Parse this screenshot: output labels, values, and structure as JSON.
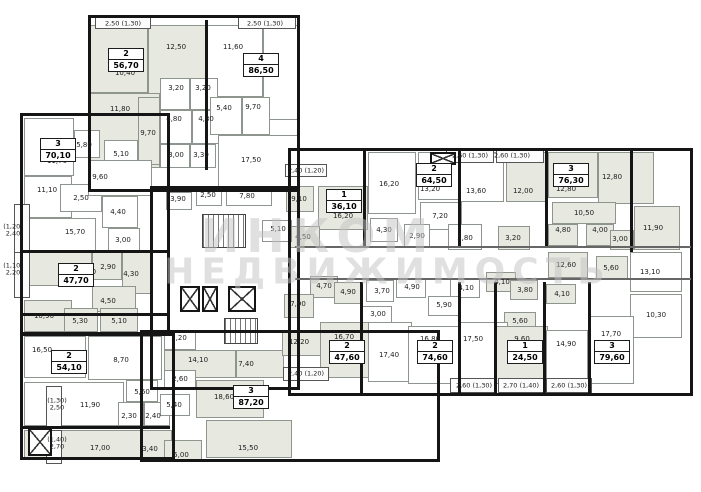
{
  "watermark": {
    "line1": "ИНКОМ",
    "line2": "НЕДВИЖИМОСТЬ"
  },
  "plan": {
    "blocks": [
      [
        88,
        15,
        212,
        177
      ],
      [
        20,
        113,
        150,
        222
      ],
      [
        20,
        333,
        155,
        127
      ],
      [
        140,
        330,
        300,
        132
      ],
      [
        288,
        148,
        405,
        248
      ],
      [
        150,
        186,
        150,
        204
      ]
    ],
    "walls": [
      [
        205,
        20,
        3,
        150,
        0
      ],
      [
        20,
        250,
        148,
        3,
        0
      ],
      [
        20,
        313,
        148,
        3,
        0
      ],
      [
        22,
        426,
        148,
        3,
        0
      ],
      [
        363,
        150,
        3,
        98,
        0
      ],
      [
        458,
        150,
        3,
        98,
        0
      ],
      [
        545,
        150,
        3,
        98,
        0
      ],
      [
        630,
        150,
        3,
        102,
        0
      ],
      [
        360,
        282,
        3,
        112,
        0
      ],
      [
        458,
        282,
        3,
        112,
        0
      ],
      [
        494,
        282,
        3,
        112,
        0
      ],
      [
        543,
        282,
        3,
        112,
        0
      ],
      [
        588,
        282,
        3,
        112,
        0
      ],
      [
        295,
        246,
        396,
        2,
        1
      ],
      [
        295,
        278,
        396,
        2,
        1
      ]
    ],
    "rooms": [
      [
        90,
        25,
        58,
        68,
        1
      ],
      [
        148,
        25,
        58,
        72,
        1
      ],
      [
        206,
        25,
        57,
        72,
        0
      ],
      [
        263,
        25,
        35,
        95,
        0
      ],
      [
        90,
        93,
        70,
        75,
        1
      ],
      [
        160,
        78,
        30,
        32,
        0
      ],
      [
        190,
        78,
        28,
        32,
        0
      ],
      [
        160,
        110,
        32,
        34,
        0
      ],
      [
        192,
        110,
        33,
        34,
        0
      ],
      [
        138,
        97,
        22,
        68,
        1
      ],
      [
        210,
        97,
        32,
        38,
        0
      ],
      [
        242,
        97,
        28,
        38,
        0
      ],
      [
        160,
        144,
        30,
        24,
        0
      ],
      [
        190,
        144,
        26,
        24,
        0
      ],
      [
        218,
        135,
        80,
        55,
        0
      ],
      [
        24,
        118,
        50,
        58,
        0
      ],
      [
        74,
        130,
        26,
        28,
        0
      ],
      [
        104,
        140,
        34,
        28,
        0
      ],
      [
        24,
        176,
        48,
        42,
        0
      ],
      [
        60,
        184,
        42,
        28,
        0
      ],
      [
        88,
        160,
        64,
        36,
        0
      ],
      [
        102,
        196,
        36,
        32,
        0
      ],
      [
        24,
        218,
        72,
        34,
        0
      ],
      [
        108,
        228,
        32,
        24,
        0
      ],
      [
        24,
        252,
        68,
        34,
        1
      ],
      [
        92,
        252,
        30,
        28,
        1
      ],
      [
        122,
        252,
        30,
        42,
        1
      ],
      [
        92,
        286,
        44,
        26,
        1
      ],
      [
        24,
        300,
        48,
        32,
        1
      ],
      [
        64,
        308,
        34,
        24,
        1
      ],
      [
        100,
        308,
        38,
        24,
        1
      ],
      [
        24,
        336,
        62,
        42,
        0
      ],
      [
        88,
        336,
        74,
        44,
        0
      ],
      [
        24,
        382,
        100,
        44,
        0
      ],
      [
        126,
        380,
        32,
        22,
        0
      ],
      [
        118,
        402,
        26,
        24,
        0
      ],
      [
        144,
        402,
        26,
        24,
        0
      ],
      [
        24,
        430,
        118,
        28,
        1
      ],
      [
        142,
        430,
        30,
        28,
        1
      ],
      [
        164,
        332,
        32,
        18,
        0
      ],
      [
        164,
        350,
        72,
        28,
        1
      ],
      [
        236,
        350,
        48,
        28,
        1
      ],
      [
        164,
        370,
        32,
        18,
        0
      ],
      [
        160,
        394,
        30,
        22,
        0
      ],
      [
        196,
        380,
        68,
        38,
        1
      ],
      [
        164,
        440,
        38,
        20,
        1
      ],
      [
        206,
        420,
        86,
        38,
        1
      ],
      [
        282,
        330,
        42,
        26,
        1
      ],
      [
        166,
        192,
        26,
        18,
        0
      ],
      [
        196,
        190,
        26,
        16,
        0
      ],
      [
        226,
        188,
        46,
        18,
        0
      ],
      [
        286,
        186,
        28,
        26,
        1
      ],
      [
        318,
        186,
        50,
        44,
        1
      ],
      [
        288,
        226,
        32,
        22,
        1
      ],
      [
        262,
        220,
        30,
        22,
        0
      ],
      [
        368,
        152,
        48,
        62,
        0
      ],
      [
        418,
        152,
        44,
        48,
        0
      ],
      [
        420,
        202,
        42,
        28,
        0
      ],
      [
        370,
        218,
        28,
        24,
        0
      ],
      [
        404,
        224,
        26,
        24,
        0
      ],
      [
        448,
        224,
        34,
        26,
        0
      ],
      [
        460,
        152,
        44,
        50,
        0
      ],
      [
        506,
        152,
        40,
        50,
        1
      ],
      [
        498,
        226,
        32,
        24,
        1
      ],
      [
        548,
        152,
        50,
        46,
        1
      ],
      [
        598,
        152,
        56,
        52,
        1
      ],
      [
        552,
        202,
        64,
        22,
        1
      ],
      [
        548,
        224,
        30,
        22,
        1
      ],
      [
        586,
        224,
        28,
        22,
        1
      ],
      [
        610,
        230,
        24,
        20,
        1
      ],
      [
        634,
        206,
        46,
        44,
        1
      ],
      [
        548,
        252,
        40,
        26,
        1
      ],
      [
        596,
        256,
        32,
        24,
        1
      ],
      [
        630,
        252,
        52,
        40,
        0
      ],
      [
        630,
        294,
        52,
        44,
        0
      ],
      [
        310,
        276,
        28,
        22,
        1
      ],
      [
        334,
        282,
        28,
        22,
        1
      ],
      [
        366,
        280,
        28,
        22,
        0
      ],
      [
        396,
        278,
        30,
        20,
        0
      ],
      [
        450,
        278,
        30,
        20,
        0
      ],
      [
        486,
        272,
        30,
        20,
        1
      ],
      [
        510,
        280,
        28,
        20,
        1
      ],
      [
        546,
        284,
        30,
        20,
        1
      ],
      [
        428,
        296,
        32,
        20,
        0
      ],
      [
        284,
        294,
        30,
        24,
        1
      ],
      [
        362,
        306,
        30,
        18,
        0
      ],
      [
        504,
        312,
        32,
        18,
        1
      ],
      [
        320,
        322,
        50,
        56,
        1
      ],
      [
        368,
        322,
        44,
        60,
        0
      ],
      [
        408,
        326,
        52,
        58,
        0
      ],
      [
        460,
        322,
        48,
        60,
        0
      ],
      [
        496,
        326,
        52,
        58,
        1
      ],
      [
        546,
        330,
        42,
        54,
        0
      ],
      [
        588,
        316,
        46,
        68,
        0
      ]
    ],
    "room_labels": [
      [
        "10,40",
        125,
        73
      ],
      [
        "12,50",
        176,
        47
      ],
      [
        "11,60",
        233,
        47
      ],
      [
        "10,10",
        258,
        74
      ],
      [
        "11,80",
        120,
        109
      ],
      [
        "3,20",
        176,
        88
      ],
      [
        "3,20",
        203,
        88
      ],
      [
        "4,80",
        174,
        119
      ],
      [
        "4,80",
        206,
        119
      ],
      [
        "9,70",
        148,
        133
      ],
      [
        "5,40",
        224,
        108
      ],
      [
        "9,70",
        253,
        107
      ],
      [
        "3,00",
        176,
        155
      ],
      [
        "3,30",
        201,
        155
      ],
      [
        "17,50",
        251,
        160
      ],
      [
        "11,70",
        57,
        161
      ],
      [
        "5,80",
        84,
        145
      ],
      [
        "5,10",
        121,
        154
      ],
      [
        "9,60",
        100,
        177
      ],
      [
        "11,10",
        47,
        190
      ],
      [
        "2,50",
        81,
        198
      ],
      [
        "4,40",
        118,
        212
      ],
      [
        "15,70",
        75,
        232
      ],
      [
        "3,00",
        123,
        240
      ],
      [
        "13,60",
        86,
        272
      ],
      [
        "2,90",
        108,
        267
      ],
      [
        "4,30",
        131,
        274
      ],
      [
        "4,50",
        108,
        301
      ],
      [
        "10,90",
        44,
        316
      ],
      [
        "5,30",
        80,
        321
      ],
      [
        "5,10",
        119,
        321
      ],
      [
        "16,50",
        42,
        350
      ],
      [
        "8,70",
        121,
        360
      ],
      [
        "11,90",
        90,
        405
      ],
      [
        "5,60",
        142,
        392
      ],
      [
        "2,30",
        129,
        416
      ],
      [
        "2,40",
        153,
        416
      ],
      [
        "17,00",
        100,
        448
      ],
      [
        "3,40",
        150,
        449
      ],
      [
        "2,20",
        179,
        338
      ],
      [
        "14,10",
        198,
        360
      ],
      [
        "7,40",
        246,
        364
      ],
      [
        "2,60",
        180,
        379
      ],
      [
        "5,40",
        174,
        405
      ],
      [
        "18,60",
        224,
        397
      ],
      [
        "5,00",
        181,
        455
      ],
      [
        "15,50",
        248,
        448
      ],
      [
        "12,20",
        299,
        342
      ],
      [
        "3,90",
        178,
        199
      ],
      [
        "2,50",
        208,
        195
      ],
      [
        "7,80",
        247,
        196
      ],
      [
        "9,10",
        299,
        199
      ],
      [
        "16,20",
        343,
        216
      ],
      [
        "4,50",
        303,
        237
      ],
      [
        "5,10",
        278,
        229
      ],
      [
        "16,20",
        389,
        184
      ],
      [
        "13,20",
        430,
        189
      ],
      [
        "7,20",
        440,
        216
      ],
      [
        "4,30",
        384,
        230
      ],
      [
        "2,90",
        417,
        236
      ],
      [
        "5,80",
        465,
        238
      ],
      [
        "13,60",
        476,
        191
      ],
      [
        "12,00",
        523,
        191
      ],
      [
        "3,20",
        513,
        238
      ],
      [
        "12,80",
        566,
        189
      ],
      [
        "12,80",
        612,
        177
      ],
      [
        "10,50",
        584,
        213
      ],
      [
        "4,80",
        563,
        230
      ],
      [
        "4,00",
        600,
        230
      ],
      [
        "3,00",
        620,
        239
      ],
      [
        "11,90",
        653,
        228
      ],
      [
        "12,60",
        566,
        265
      ],
      [
        "5,60",
        611,
        268
      ],
      [
        "13,10",
        650,
        272
      ],
      [
        "10,30",
        656,
        315
      ],
      [
        "4,70",
        324,
        286
      ],
      [
        "4,90",
        348,
        292
      ],
      [
        "3,70",
        382,
        291
      ],
      [
        "4,90",
        412,
        287
      ],
      [
        "4,10",
        466,
        288
      ],
      [
        "4,10",
        502,
        282
      ],
      [
        "3,80",
        525,
        290
      ],
      [
        "4,10",
        562,
        294
      ],
      [
        "5,90",
        444,
        305
      ],
      [
        "7,90",
        298,
        304
      ],
      [
        "3,00",
        378,
        314
      ],
      [
        "5,60",
        520,
        321
      ],
      [
        "16,70",
        344,
        337
      ],
      [
        "17,40",
        389,
        355
      ],
      [
        "16,80",
        430,
        339
      ],
      [
        "17,50",
        473,
        339
      ],
      [
        "9,60",
        522,
        339
      ],
      [
        "14,90",
        566,
        344
      ],
      [
        "17,70",
        611,
        334
      ]
    ],
    "apartments": [
      {
        "n": "2",
        "a": "56,70",
        "x": 108,
        "y": 48
      },
      {
        "n": "4",
        "a": "86,50",
        "x": 243,
        "y": 53
      },
      {
        "n": "3",
        "a": "70,10",
        "x": 40,
        "y": 138
      },
      {
        "n": "2",
        "a": "47,70",
        "x": 58,
        "y": 263
      },
      {
        "n": "2",
        "a": "54,10",
        "x": 51,
        "y": 350
      },
      {
        "n": "3",
        "a": "87,20",
        "x": 233,
        "y": 385
      },
      {
        "n": "1",
        "a": "36,10",
        "x": 326,
        "y": 189
      },
      {
        "n": "2",
        "a": "64,50",
        "x": 416,
        "y": 163
      },
      {
        "n": "3",
        "a": "76,30",
        "x": 553,
        "y": 163
      },
      {
        "n": "2",
        "a": "47,60",
        "x": 329,
        "y": 340
      },
      {
        "n": "2",
        "a": "74,60",
        "x": 417,
        "y": 340
      },
      {
        "n": "1",
        "a": "24,50",
        "x": 507,
        "y": 340
      },
      {
        "n": "3",
        "a": "79,60",
        "x": 594,
        "y": 340
      }
    ],
    "balconies": [
      [
        95,
        16,
        56,
        13
      ],
      [
        238,
        16,
        58,
        13
      ],
      [
        285,
        164,
        42,
        13
      ],
      [
        446,
        150,
        48,
        13
      ],
      [
        496,
        150,
        48,
        13
      ],
      [
        283,
        367,
        46,
        14
      ],
      [
        450,
        378,
        46,
        15
      ],
      [
        498,
        378,
        46,
        15
      ],
      [
        546,
        378,
        46,
        15
      ],
      [
        14,
        204,
        16,
        52
      ],
      [
        14,
        252,
        16,
        46
      ],
      [
        46,
        386,
        16,
        42
      ],
      [
        46,
        430,
        16,
        34
      ]
    ],
    "balcony_labels": [
      [
        "2,50 (1,30)",
        123,
        24
      ],
      [
        "2,50 (1,30)",
        265,
        24
      ],
      [
        "2,40 (1,20)",
        306,
        171
      ],
      [
        "2,60 (1,30)",
        470,
        156
      ],
      [
        "2,60 (1,30)",
        512,
        156
      ],
      [
        "2,40 (1,20)",
        306,
        374
      ],
      [
        "2,60 (1,30)",
        474,
        386
      ],
      [
        "2,70 (1,40)",
        521,
        386
      ],
      [
        "2,60 (1,30)",
        569,
        386
      ],
      [
        "(1,20)\n2,40",
        13,
        231
      ],
      [
        "(1,10)\n2,20",
        13,
        270
      ],
      [
        "(1,30)\n2,50",
        57,
        405
      ],
      [
        "(1,40)\n2,70",
        57,
        444
      ]
    ],
    "lifts": [
      [
        180,
        286,
        20,
        26
      ],
      [
        202,
        286,
        16,
        26
      ],
      [
        228,
        286,
        28,
        26
      ],
      [
        28,
        428,
        24,
        28
      ],
      [
        430,
        152,
        26,
        13
      ]
    ],
    "stairs": [
      [
        202,
        214,
        44,
        34
      ],
      [
        224,
        318,
        34,
        26
      ]
    ]
  }
}
